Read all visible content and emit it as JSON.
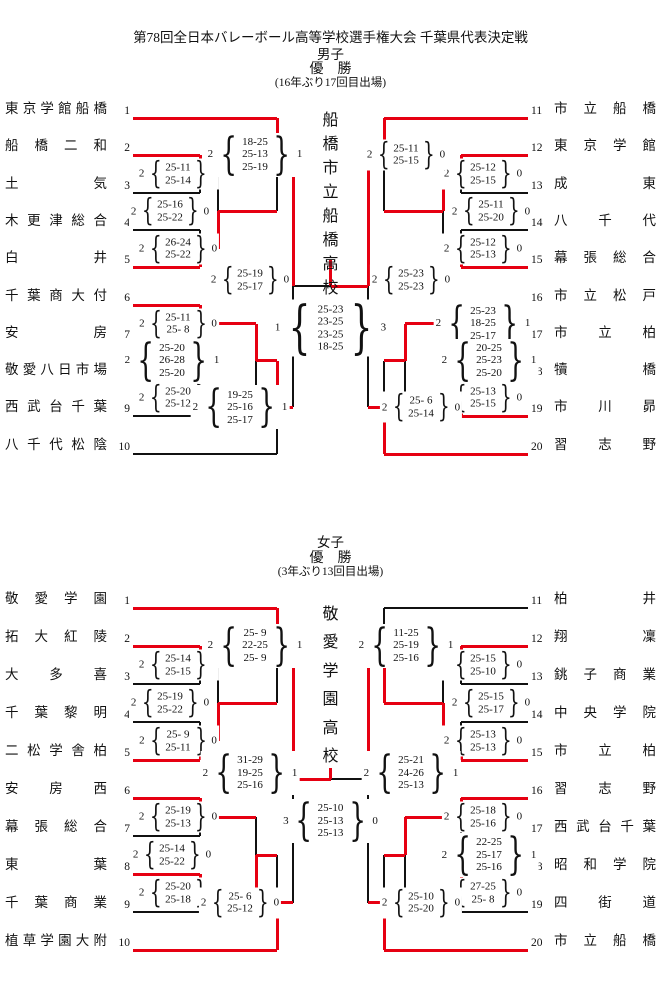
{
  "page": {
    "title": "第78回全日本バレーボール高等学校選手権大会 千葉県代表決定戦"
  },
  "accent_color": "#e60012",
  "brackets": [
    {
      "id": "men",
      "gender_label": "男子",
      "result_label": "優　勝",
      "note": "(16年ぶり17回目出場)",
      "champion": "船橋市立船橋高校",
      "left_teams": [
        {
          "seed": "1",
          "name": "東京学館船橋",
          "red": true
        },
        {
          "seed": "2",
          "name": "船橋二和",
          "red": true
        },
        {
          "seed": "3",
          "name": "土気",
          "red": false
        },
        {
          "seed": "4",
          "name": "木更津総合",
          "red": false
        },
        {
          "seed": "5",
          "name": "白井",
          "red": true
        },
        {
          "seed": "6",
          "name": "千葉商大付",
          "red": true
        },
        {
          "seed": "7",
          "name": "安房",
          "red": false
        },
        {
          "seed": "8",
          "name": "敬愛八日市場",
          "red": true
        },
        {
          "seed": "9",
          "name": "西武台千葉",
          "red": false
        },
        {
          "seed": "10",
          "name": "八千代松陰",
          "red": false
        }
      ],
      "right_teams": [
        {
          "seed": "11",
          "name": "市立船橋",
          "red": true
        },
        {
          "seed": "12",
          "name": "東京学館",
          "red": true
        },
        {
          "seed": "13",
          "name": "成東",
          "red": false
        },
        {
          "seed": "14",
          "name": "八千代",
          "red": false
        },
        {
          "seed": "15",
          "name": "幕張総合",
          "red": true
        },
        {
          "seed": "16",
          "name": "市立松戸",
          "red": false
        },
        {
          "seed": "17",
          "name": "市立柏",
          "red": true
        },
        {
          "seed": "18",
          "name": "犢橋",
          "red": false
        },
        {
          "seed": "19",
          "name": "市川昴",
          "red": true
        },
        {
          "seed": "20",
          "name": "習志野",
          "red": true
        }
      ],
      "left_matches": {
        "m1": {
          "w": "2",
          "l": "0",
          "sets": [
            "25-11",
            "25-14"
          ],
          "winner": "top"
        },
        "m2": {
          "w": "2",
          "l": "0",
          "sets": [
            "26-24",
            "25-22"
          ],
          "winner": "bottom"
        },
        "m3": {
          "w": "2",
          "l": "0",
          "sets": [
            "25-16",
            "25-22"
          ],
          "winner": "bottom"
        },
        "m4": {
          "w": "2",
          "l": "1",
          "sets": [
            "18-25",
            "25-13",
            "25-19"
          ],
          "winner": "top"
        },
        "m5": {
          "w": "2",
          "l": "0",
          "sets": [
            "25-11",
            "25- 8"
          ],
          "winner": "top"
        },
        "m6": {
          "w": "2",
          "l": "0",
          "sets": [
            "25-20",
            "25-12"
          ],
          "winner": "top"
        },
        "m7": {
          "w": "2",
          "l": "1",
          "sets": [
            "25-20",
            "26-28",
            "25-20"
          ],
          "winner": "top"
        },
        "m8": {
          "w": "2",
          "l": "1",
          "sets": [
            "19-25",
            "25-16",
            "25-17"
          ],
          "winner": "top"
        },
        "sf": {
          "w": "2",
          "l": "0",
          "sets": [
            "25-19",
            "25-17"
          ],
          "winner": "top"
        }
      },
      "right_matches": {
        "m1": {
          "w": "2",
          "l": "0",
          "sets": [
            "25-12",
            "25-15"
          ],
          "winner": "top"
        },
        "m2": {
          "w": "2",
          "l": "0",
          "sets": [
            "25-12",
            "25-13"
          ],
          "winner": "bottom"
        },
        "m3": {
          "w": "2",
          "l": "0",
          "sets": [
            "25-11",
            "25-20"
          ],
          "winner": "top"
        },
        "m4": {
          "w": "2",
          "l": "0",
          "sets": [
            "25-11",
            "25-15"
          ],
          "winner": "top"
        },
        "m5": {
          "w": "2",
          "l": "1",
          "sets": [
            "25-23",
            "18-25",
            "25-17"
          ],
          "winner": "bottom"
        },
        "m6": {
          "w": "2",
          "l": "0",
          "sets": [
            "25-13",
            "25-15"
          ],
          "winner": "bottom"
        },
        "m7": {
          "w": "2",
          "l": "1",
          "sets": [
            "20-25",
            "25-23",
            "25-20"
          ],
          "winner": "top"
        },
        "m8": {
          "w": "2",
          "l": "0",
          "sets": [
            "25- 6",
            "25-14"
          ],
          "winner": "bottom"
        },
        "sf": {
          "w": "2",
          "l": "0",
          "sets": [
            "25-23",
            "25-23"
          ],
          "winner": "top"
        }
      },
      "final": {
        "left": "1",
        "right": "3",
        "sets": [
          "25-23",
          "23-25",
          "23-25",
          "18-25"
        ],
        "winner": "right"
      }
    },
    {
      "id": "women",
      "gender_label": "女子",
      "result_label": "優　勝",
      "note": "(3年ぶり13回目出場)",
      "champion": "敬愛学園高校",
      "left_teams": [
        {
          "seed": "1",
          "name": "敬愛学園",
          "red": true
        },
        {
          "seed": "2",
          "name": "拓大紅陵",
          "red": true
        },
        {
          "seed": "3",
          "name": "大多喜",
          "red": false
        },
        {
          "seed": "4",
          "name": "千葉黎明",
          "red": false
        },
        {
          "seed": "5",
          "name": "二松学舎柏",
          "red": true
        },
        {
          "seed": "6",
          "name": "安房西",
          "red": true
        },
        {
          "seed": "7",
          "name": "幕張総合",
          "red": false
        },
        {
          "seed": "8",
          "name": "東葉",
          "red": true
        },
        {
          "seed": "9",
          "name": "千葉商業",
          "red": false
        },
        {
          "seed": "10",
          "name": "植草学園大附",
          "red": true
        }
      ],
      "right_teams": [
        {
          "seed": "11",
          "name": "柏井",
          "red": false
        },
        {
          "seed": "12",
          "name": "翔凜",
          "red": true
        },
        {
          "seed": "13",
          "name": "銚子商業",
          "red": false
        },
        {
          "seed": "14",
          "name": "中央学院",
          "red": false
        },
        {
          "seed": "15",
          "name": "市立柏",
          "red": true
        },
        {
          "seed": "16",
          "name": "習志野",
          "red": true
        },
        {
          "seed": "17",
          "name": "西武台千葉",
          "red": false
        },
        {
          "seed": "18",
          "name": "昭和学院",
          "red": true
        },
        {
          "seed": "19",
          "name": "四街道",
          "red": false
        },
        {
          "seed": "20",
          "name": "市立船橋",
          "red": true
        }
      ],
      "left_matches": {
        "m1": {
          "w": "2",
          "l": "0",
          "sets": [
            "25-14",
            "25-15"
          ],
          "winner": "top"
        },
        "m2": {
          "w": "2",
          "l": "0",
          "sets": [
            "25- 9",
            "25-11"
          ],
          "winner": "bottom"
        },
        "m3": {
          "w": "2",
          "l": "0",
          "sets": [
            "25-19",
            "25-22"
          ],
          "winner": "bottom"
        },
        "m4": {
          "w": "2",
          "l": "1",
          "sets": [
            "25- 9",
            "22-25",
            "25- 9"
          ],
          "winner": "top"
        },
        "m5": {
          "w": "2",
          "l": "0",
          "sets": [
            "25-19",
            "25-13"
          ],
          "winner": "top"
        },
        "m6": {
          "w": "2",
          "l": "0",
          "sets": [
            "25-20",
            "25-18"
          ],
          "winner": "top"
        },
        "m7": {
          "w": "2",
          "l": "0",
          "sets": [
            "25-14",
            "25-22"
          ],
          "winner": "bottom"
        },
        "m8": {
          "w": "2",
          "l": "0",
          "sets": [
            "25- 6",
            "25-12"
          ],
          "winner": "bottom"
        },
        "sf": {
          "w": "2",
          "l": "1",
          "sets": [
            "31-29",
            "19-25",
            "25-16"
          ],
          "winner": "top"
        }
      },
      "right_matches": {
        "m1": {
          "w": "2",
          "l": "0",
          "sets": [
            "25-15",
            "25-10"
          ],
          "winner": "top"
        },
        "m2": {
          "w": "2",
          "l": "0",
          "sets": [
            "25-13",
            "25-13"
          ],
          "winner": "bottom"
        },
        "m3": {
          "w": "2",
          "l": "0",
          "sets": [
            "25-15",
            "25-17"
          ],
          "winner": "bottom"
        },
        "m4": {
          "w": "2",
          "l": "1",
          "sets": [
            "11-25",
            "25-19",
            "25-16"
          ],
          "winner": "bottom"
        },
        "m5": {
          "w": "2",
          "l": "0",
          "sets": [
            "25-18",
            "25-16"
          ],
          "winner": "top"
        },
        "m6": {
          "w": "2",
          "l": "0",
          "sets": [
            "27-25",
            "25- 8"
          ],
          "winner": "top"
        },
        "m7": {
          "w": "2",
          "l": "1",
          "sets": [
            "22-25",
            "25-17",
            "25-16"
          ],
          "winner": "top"
        },
        "m8": {
          "w": "2",
          "l": "0",
          "sets": [
            "25-10",
            "25-20"
          ],
          "winner": "bottom"
        },
        "sf": {
          "w": "2",
          "l": "1",
          "sets": [
            "25-21",
            "24-26",
            "25-13"
          ],
          "winner": "top"
        }
      },
      "final": {
        "left": "3",
        "right": "0",
        "sets": [
          "25-10",
          "25-13",
          "25-13"
        ],
        "winner": "left"
      }
    }
  ]
}
